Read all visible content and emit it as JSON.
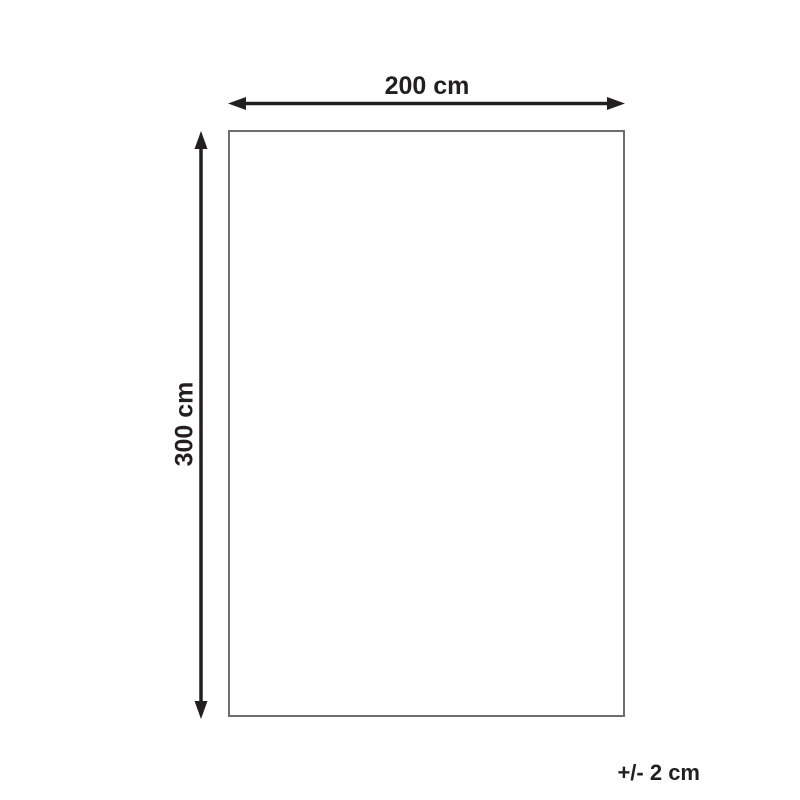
{
  "diagram": {
    "type": "product-dimension-diagram",
    "width_label": "200 cm",
    "height_label": "300 cm",
    "tolerance_label": "+/- 2 cm",
    "colors": {
      "arrow": "#231f20",
      "label_text": "#231f20",
      "outline_stroke": "#6e6e6e",
      "outline_fill": "#ffffff",
      "background": "#ffffff"
    }
  }
}
